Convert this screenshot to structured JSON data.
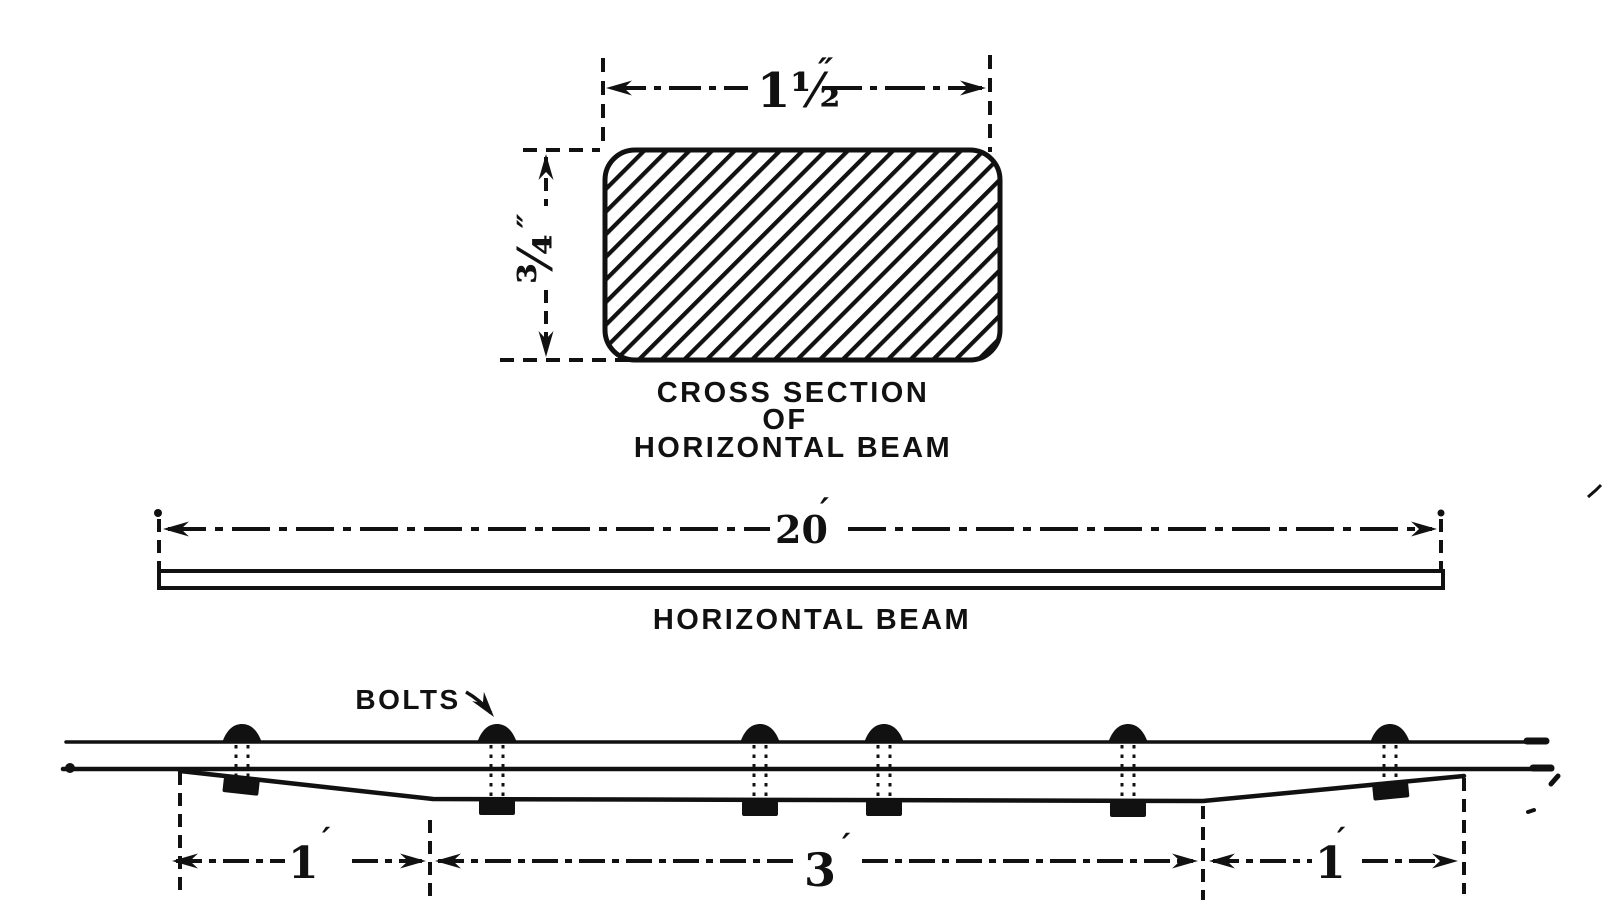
{
  "figure": {
    "ink_color": "#111111",
    "paper_color": "#ffffff",
    "cross_section": {
      "width_value": "1½",
      "width_unit": "″",
      "depth_value": "¾",
      "depth_unit": "″",
      "caption": [
        "CROSS SECTION",
        "OF",
        "HORIZONTAL BEAM"
      ]
    },
    "elevation": {
      "length_value": "20",
      "length_unit": "′",
      "caption": "HORIZONTAL BEAM"
    },
    "plan": {
      "bolts_label": "BOLTS",
      "bolt_count": 6,
      "segment_dims": [
        {
          "value": "1",
          "unit": "′"
        },
        {
          "value": "3",
          "unit": "′"
        },
        {
          "value": "1",
          "unit": "′"
        }
      ]
    }
  }
}
